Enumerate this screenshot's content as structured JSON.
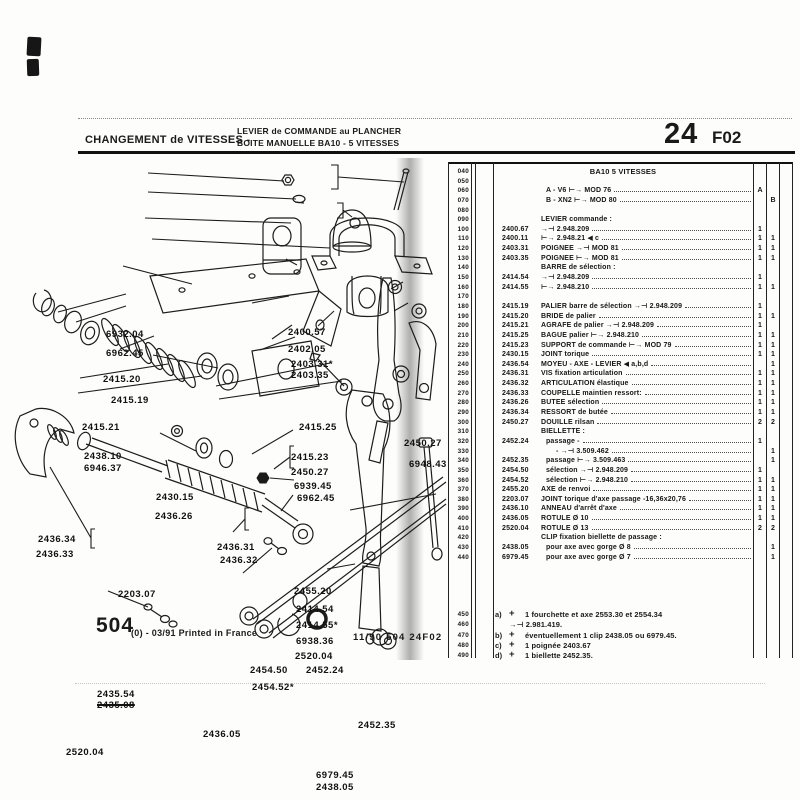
{
  "colors": {
    "ink": "#1a1a1a",
    "paper": "#ffffff"
  },
  "header": {
    "title_left": "CHANGEMENT de VITESSES -",
    "subtitle_line1": "LEVIER de COMMANDE au PLANCHER",
    "subtitle_line2": "BOITE MANUELLE BA10 - 5 VITESSES",
    "page_number": "24",
    "page_code": "F02"
  },
  "table": {
    "rows": [
      {
        "code": "040",
        "cls": "title",
        "desc": "BA10 5 VITESSES"
      },
      {
        "code": "050"
      },
      {
        "code": "060",
        "cls": "dots ind1",
        "desc": "A - V6 ⊢→  MOD 76",
        "qa": "A"
      },
      {
        "code": "070",
        "cls": "dots ind1",
        "desc": "B - XN2 ⊢→  MOD 80",
        "qb": "B"
      },
      {
        "code": "080"
      },
      {
        "code": "090",
        "cls": "section",
        "desc": "LEVIER commande :"
      },
      {
        "code": "100",
        "ref": "2400.67",
        "cls": "dots",
        "desc": "→⊣ 2.948.209",
        "qa": "1"
      },
      {
        "code": "110",
        "ref": "2400.11",
        "cls": "dots",
        "desc": "⊢→ 2.948.21  ◀ c",
        "qa": "1",
        "qb": "1"
      },
      {
        "code": "120",
        "ref": "2403.31",
        "cls": "dots",
        "desc": "POIGNEE →⊣ MOD 81",
        "qa": "1",
        "qb": "1"
      },
      {
        "code": "130",
        "ref": "2403.35",
        "cls": "dots",
        "desc": "POIGNEE ⊢→ MOD 81",
        "qa": "1",
        "qb": "1"
      },
      {
        "code": "140",
        "cls": "section",
        "desc": "BARRE de sélection :"
      },
      {
        "code": "150",
        "ref": "2414.54",
        "cls": "dots",
        "desc": "→⊣ 2.948.209",
        "qa": "1"
      },
      {
        "code": "160",
        "ref": "2414.55",
        "cls": "dots",
        "desc": "⊢→ 2.948.210",
        "qa": "1",
        "qb": "1"
      },
      {
        "code": "170"
      },
      {
        "code": "180",
        "ref": "2415.19",
        "cls": "dots",
        "desc": "PALIER barre de sélection →⊣ 2.948.209",
        "qa": "1"
      },
      {
        "code": "190",
        "ref": "2415.20",
        "cls": "dots",
        "desc": "BRIDE de palier",
        "qa": "1",
        "qb": "1"
      },
      {
        "code": "200",
        "ref": "2415.21",
        "cls": "dots",
        "desc": "AGRAFE de palier →⊣ 2.948.209",
        "qa": "1"
      },
      {
        "code": "210",
        "ref": "2415.25",
        "cls": "dots",
        "desc": "BAGUE palier ⊢→ 2.948.210",
        "qa": "1",
        "qb": "1"
      },
      {
        "code": "220",
        "ref": "2415.23",
        "cls": "dots",
        "desc": "SUPPORT de commande ⊢→  MOD 79",
        "qa": "1",
        "qb": "1"
      },
      {
        "code": "230",
        "ref": "2430.15",
        "cls": "dots",
        "desc": "JOINT torique",
        "qa": "1",
        "qb": "1"
      },
      {
        "code": "240",
        "ref": "2436.54",
        "cls": "dots",
        "desc": "MOYEU - AXE - LEVIER  ◀ a,b,d",
        "qb": "1"
      },
      {
        "code": "250",
        "ref": "2436.31",
        "cls": "dots",
        "desc": "VIS fixation articulation",
        "qa": "1",
        "qb": "1"
      },
      {
        "code": "260",
        "ref": "2436.32",
        "cls": "dots",
        "desc": "ARTICULATION élastique",
        "qa": "1",
        "qb": "1"
      },
      {
        "code": "270",
        "ref": "2436.33",
        "cls": "dots",
        "desc": "COUPELLE maintien ressort:",
        "qa": "1",
        "qb": "1"
      },
      {
        "code": "280",
        "ref": "2436.26",
        "cls": "dots",
        "desc": "BUTEE sélection",
        "qa": "1",
        "qb": "1"
      },
      {
        "code": "290",
        "ref": "2436.34",
        "cls": "dots",
        "desc": "RESSORT de butée",
        "qa": "1",
        "qb": "1"
      },
      {
        "code": "300",
        "ref": "2450.27",
        "cls": "dots",
        "desc": "DOUILLE rilsan",
        "qa": "2",
        "qb": "2"
      },
      {
        "code": "310",
        "cls": "section",
        "desc": "BIELLETTE :"
      },
      {
        "code": "320",
        "ref": "2452.24",
        "cls": "dots ind1",
        "desc": "passage -",
        "qa": "1"
      },
      {
        "code": "330",
        "cls": "dots ind2",
        "desc": "- →⊣ 3.509.462",
        "qb": "1"
      },
      {
        "code": "340",
        "ref": "2452.35",
        "cls": "dots ind1",
        "desc": "passage ⊢→  3.509.463",
        "qb": "1"
      },
      {
        "code": "350",
        "ref": "2454.50",
        "cls": "dots ind1",
        "desc": "sélection →⊣ 2.948.209",
        "qa": "1"
      },
      {
        "code": "360",
        "ref": "2454.52",
        "cls": "dots ind1",
        "desc": "sélection ⊢→  2.948.210",
        "qa": "1",
        "qb": "1"
      },
      {
        "code": "370",
        "ref": "2455.20",
        "cls": "dots",
        "desc": "AXE de renvoi",
        "qa": "1",
        "qb": "1"
      },
      {
        "code": "380",
        "ref": "2203.07",
        "cls": "dots",
        "desc": "JOINT torique d'axe passage -16,36x20,76",
        "qa": "1",
        "qb": "1"
      },
      {
        "code": "390",
        "ref": "2436.10",
        "cls": "dots",
        "desc": "ANNEAU d'arrêt d'axe",
        "qa": "1",
        "qb": "1"
      },
      {
        "code": "400",
        "ref": "2436.05",
        "cls": "dots",
        "desc": "ROTULE Ø 10",
        "qa": "1",
        "qb": "1"
      },
      {
        "code": "410",
        "ref": "2520.04",
        "cls": "dots",
        "desc": "ROTULE Ø 13",
        "qa": "2",
        "qb": "2"
      },
      {
        "code": "420",
        "cls": "section",
        "desc": "CLIP fixation biellette de passage :"
      },
      {
        "code": "430",
        "ref": "2438.05",
        "cls": "dots ind1",
        "desc": "pour axe avec gorge Ø 8",
        "qb": "1"
      },
      {
        "code": "440",
        "ref": "6979.45",
        "cls": "dots ind1",
        "desc": "pour axe avec gorge Ø 7",
        "qb": "1"
      }
    ],
    "footnotes": [
      {
        "code": "450",
        "letter": "a)",
        "plus": "+",
        "text": "1 fourchette et axe 2553.30 et 2554.34"
      },
      {
        "code": "460",
        "letter": "",
        "plus": "",
        "cls": "find",
        "text": "→⊣ 2.981.419."
      },
      {
        "code": "470",
        "letter": "b)",
        "plus": "+",
        "text": "éventuellement 1 clip 2438.05 ou 6979.45."
      },
      {
        "code": "480",
        "letter": "c)",
        "plus": "+",
        "text": "1 poignée 2403.67"
      },
      {
        "code": "490",
        "letter": "d)",
        "plus": "+",
        "text": "1 biellette 2452.35."
      }
    ]
  },
  "diagram": {
    "labels": [
      {
        "text": "6932.04",
        "x": 106,
        "y": 169
      },
      {
        "text": "6962.45",
        "x": 106,
        "y": 188
      },
      {
        "text": "2415.20",
        "x": 103,
        "y": 214
      },
      {
        "text": "2415.19",
        "x": 111,
        "y": 235
      },
      {
        "text": "2415.21",
        "x": 82,
        "y": 262
      },
      {
        "text": "2400.57",
        "x": 288,
        "y": 167
      },
      {
        "text": "2402.05",
        "x": 288,
        "y": 184
      },
      {
        "text": "2403.31*",
        "x": 291,
        "y": 199
      },
      {
        "text": "2403.35",
        "x": 291,
        "y": 210
      },
      {
        "text": "2415.25",
        "x": 299,
        "y": 262
      },
      {
        "text": "2438.10",
        "x": 84,
        "y": 291
      },
      {
        "text": "6946.37",
        "x": 84,
        "y": 303
      },
      {
        "text": "2415.23",
        "x": 291,
        "y": 292
      },
      {
        "text": "2450.27",
        "x": 291,
        "y": 307
      },
      {
        "text": "6939.45",
        "x": 294,
        "y": 321
      },
      {
        "text": "6962.45",
        "x": 297,
        "y": 333
      },
      {
        "text": "2450.27",
        "x": 404,
        "y": 278
      },
      {
        "text": "6948.43",
        "x": 409,
        "y": 299
      },
      {
        "text": "2430.15",
        "x": 156,
        "y": 332
      },
      {
        "text": "2436.26",
        "x": 155,
        "y": 351
      },
      {
        "text": "2436.34",
        "x": 38,
        "y": 374
      },
      {
        "text": "2436.33",
        "x": 36,
        "y": 389
      },
      {
        "text": "2436.31",
        "x": 217,
        "y": 382
      },
      {
        "text": "2436.32",
        "x": 220,
        "y": 395
      },
      {
        "text": "2203.07",
        "x": 118,
        "y": 429
      },
      {
        "text": "2455.20",
        "x": 294,
        "y": 426
      },
      {
        "text": "2414.54",
        "x": 296,
        "y": 444
      },
      {
        "text": "2414.55*",
        "x": 296,
        "y": 460
      },
      {
        "text": "6938.36",
        "x": 296,
        "y": 476
      },
      {
        "text": "2520.04",
        "x": 295,
        "y": 491
      },
      {
        "text": "2454.50",
        "x": 250,
        "y": 505
      },
      {
        "text": "2452.24",
        "x": 306,
        "y": 505
      },
      {
        "text": "2454.52*",
        "x": 252,
        "y": 522
      },
      {
        "text": "2435.54",
        "x": 97,
        "y": 529
      },
      {
        "text": "2435.08",
        "x": 97,
        "y": 540,
        "cls": "strike"
      },
      {
        "text": "2436.05",
        "x": 203,
        "y": 569
      },
      {
        "text": "2452.35",
        "x": 358,
        "y": 560
      },
      {
        "text": "2520.04",
        "x": 66,
        "y": 587
      },
      {
        "text": "6979.45",
        "x": 316,
        "y": 610
      },
      {
        "text": "2438.05",
        "x": 316,
        "y": 622
      }
    ]
  },
  "footer": {
    "big_number": "504",
    "left_rest": "(0) - 03/91 Printed in France",
    "center": "11/90 504 24F02"
  }
}
